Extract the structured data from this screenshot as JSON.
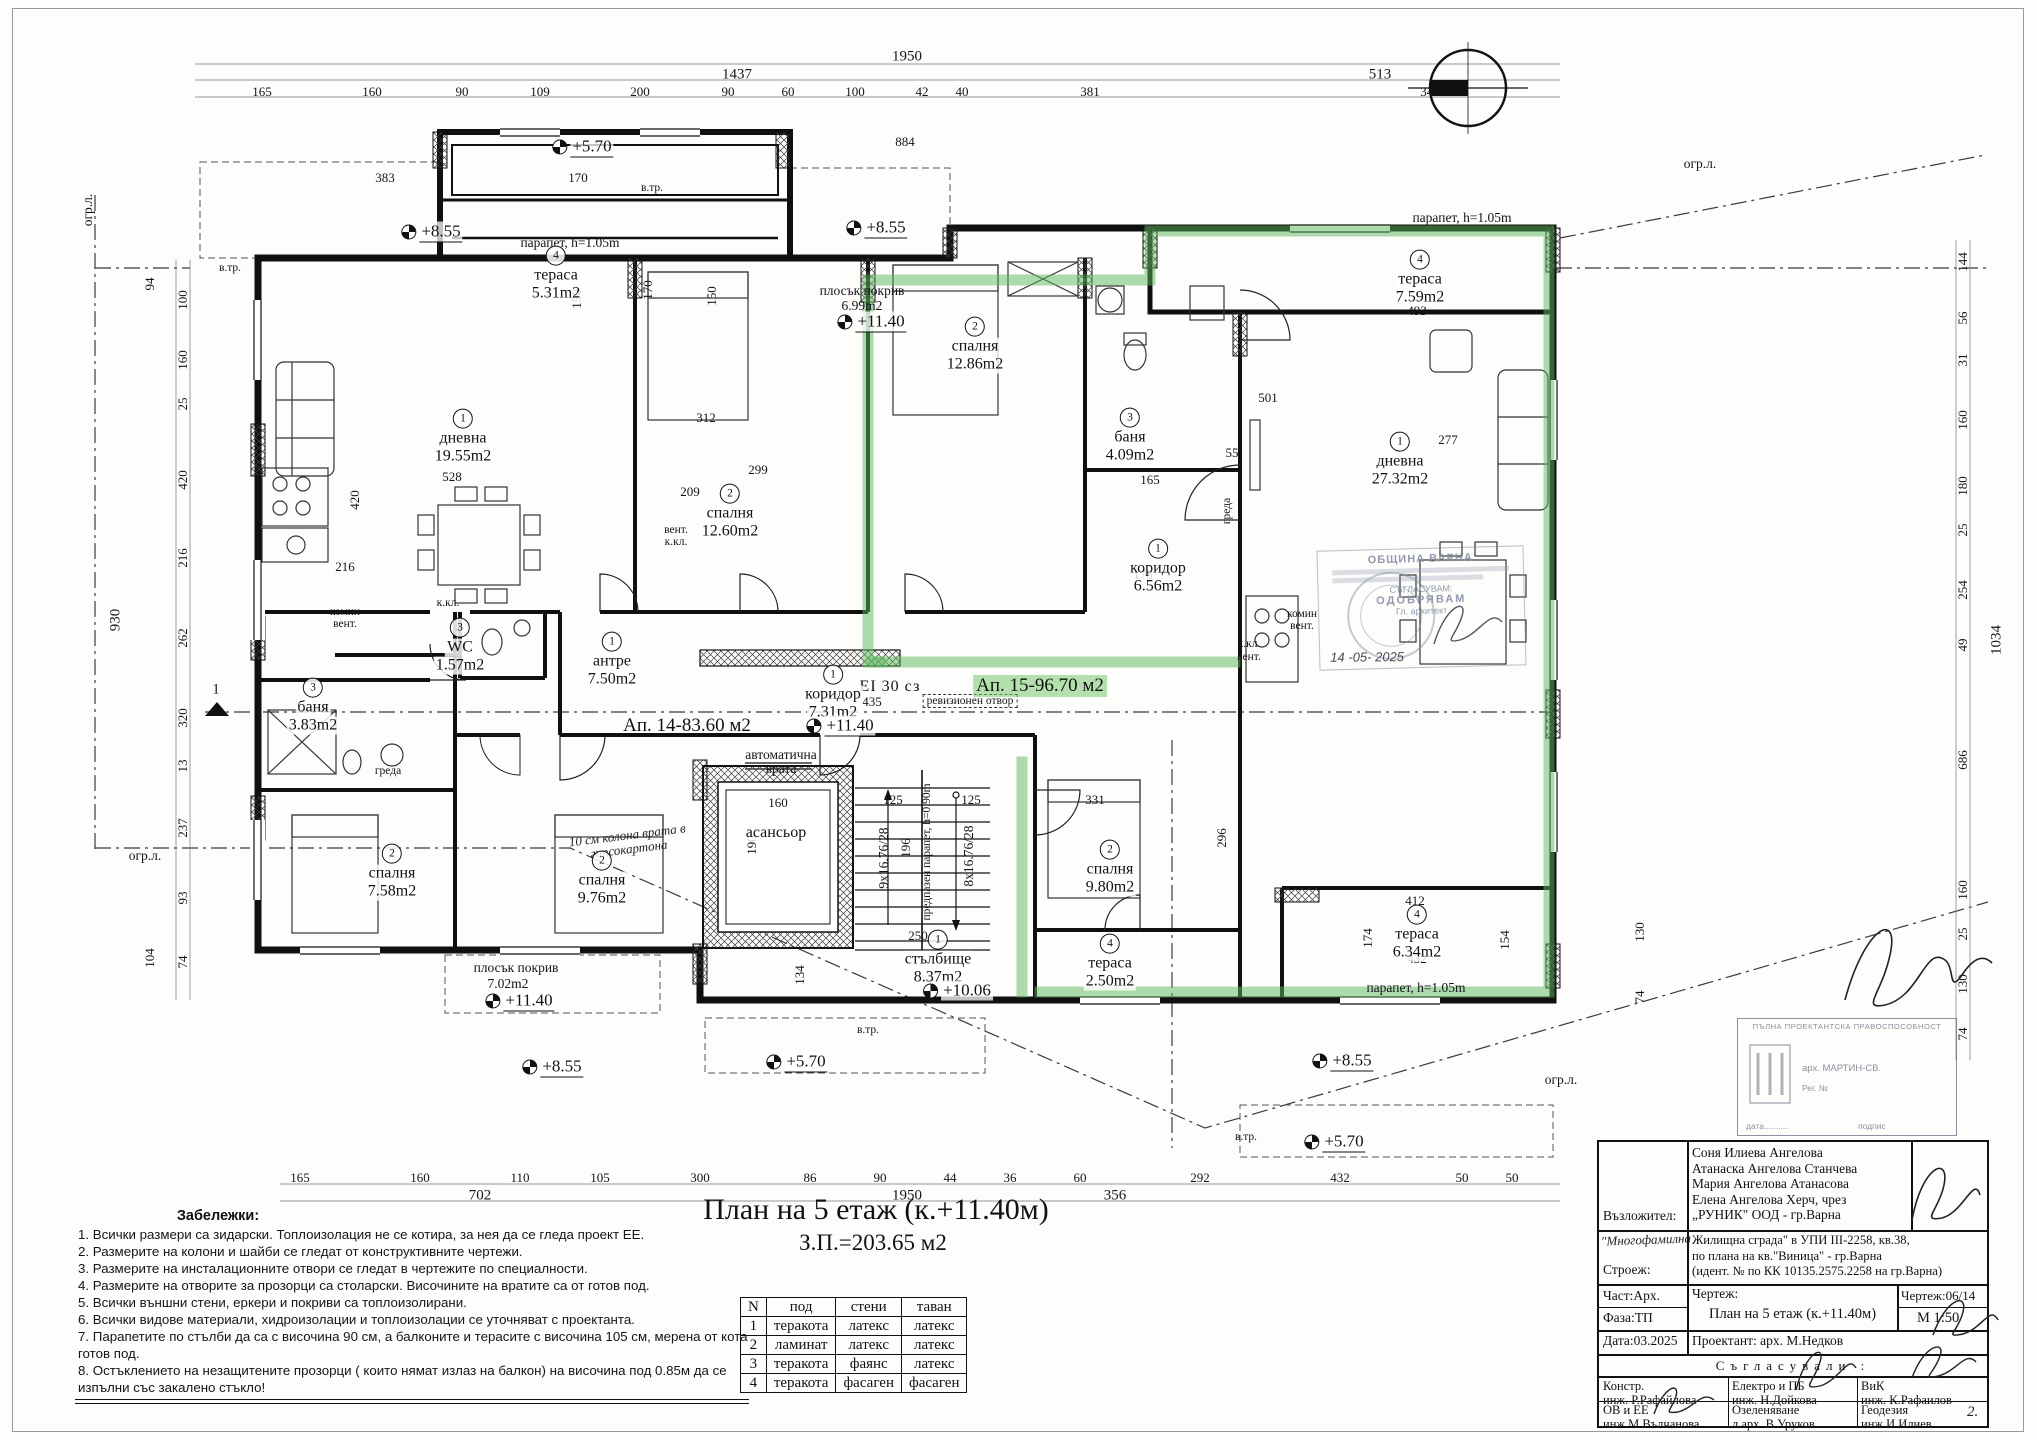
{
  "page": {
    "sheet_title": "План на 5 етаж (к.+11.40м)",
    "sheet_area": "З.П.=203.65 м2"
  },
  "colors": {
    "highlight_green": "#5cb85c",
    "ink": "#111111",
    "stamp_blue": "#8a92a8"
  },
  "apartments": [
    {
      "t": "Ап. 14-83.60 м2",
      "x": 687,
      "y": 726
    },
    {
      "t": "Ап. 15-96.70 м2",
      "x": 1040,
      "y": 686,
      "cls": "hl"
    }
  ],
  "rooms": [
    {
      "n": "4",
      "name": "тераса",
      "area": "5.31m2",
      "x": 556,
      "y": 274
    },
    {
      "n": "1",
      "name": "дневна",
      "area": "19.55m2",
      "x": 463,
      "y": 437
    },
    {
      "n": "2",
      "name": "спалня",
      "area": "12.60m2",
      "x": 730,
      "y": 512
    },
    {
      "n": "2",
      "name": "спалня",
      "area": "12.86m2",
      "x": 975,
      "y": 345
    },
    {
      "n": "3",
      "name": "баня",
      "area": "4.09m2",
      "x": 1130,
      "y": 436
    },
    {
      "n": "4",
      "name": "тераса",
      "area": "7.59m2",
      "x": 1420,
      "y": 278
    },
    {
      "n": "1",
      "name": "дневна",
      "area": "27.32m2",
      "x": 1400,
      "y": 460
    },
    {
      "n": "1",
      "name": "коридор",
      "area": "6.56m2",
      "x": 1158,
      "y": 567
    },
    {
      "n": "3",
      "name": "WC",
      "area": "1.57m2",
      "x": 460,
      "y": 646
    },
    {
      "n": "1",
      "name": "антре",
      "area": "7.50m2",
      "x": 612,
      "y": 660
    },
    {
      "n": "3",
      "name": "баня",
      "area": "3.83m2",
      "x": 313,
      "y": 706
    },
    {
      "n": "1",
      "name": "коридор",
      "area": "7.31m2",
      "x": 833,
      "y": 693
    },
    {
      "n": "2",
      "name": "спалня",
      "area": "7.58m2",
      "x": 392,
      "y": 872
    },
    {
      "n": "2",
      "name": "спалня",
      "area": "9.76m2",
      "x": 602,
      "y": 879
    },
    {
      "name": "асансьор",
      "x": 776,
      "y": 833
    },
    {
      "n": "1",
      "name": "стълбище",
      "area": "8.37m2",
      "x": 938,
      "y": 958
    },
    {
      "n": "2",
      "name": "спалня",
      "area": "9.80m2",
      "x": 1110,
      "y": 868
    },
    {
      "n": "4",
      "name": "тераса",
      "area": "2.50m2",
      "x": 1110,
      "y": 962
    },
    {
      "n": "4",
      "name": "тераса",
      "area": "6.34m2",
      "x": 1417,
      "y": 933
    }
  ],
  "elevations": [
    {
      "t": "+5.70",
      "x": 583,
      "y": 147
    },
    {
      "t": "+8.55",
      "x": 432,
      "y": 232
    },
    {
      "t": "+8.55",
      "x": 877,
      "y": 228
    },
    {
      "t": "+11.40",
      "x": 872,
      "y": 322
    },
    {
      "t": "+11.40",
      "x": 841,
      "y": 726
    },
    {
      "t": "+10.06",
      "x": 958,
      "y": 991
    },
    {
      "t": "+11.40",
      "x": 520,
      "y": 1001
    },
    {
      "t": "+5.70",
      "x": 797,
      "y": 1062
    },
    {
      "t": "+8.55",
      "x": 553,
      "y": 1067
    },
    {
      "t": "+8.55",
      "x": 1343,
      "y": 1061
    },
    {
      "t": "+5.70",
      "x": 1335,
      "y": 1142
    }
  ],
  "annotations": [
    {
      "t": "парапет, h=1.05m",
      "x": 570,
      "y": 243
    },
    {
      "t": "парапет, h=1.05m",
      "x": 1462,
      "y": 218
    },
    {
      "t": "парапет, h=1.05m",
      "x": 1416,
      "y": 988
    },
    {
      "t": "автоматична врата",
      "x": 781,
      "y": 762,
      "w": 100
    },
    {
      "t": "предпазен парапет, h=0.90m",
      "x": 927,
      "y": 852,
      "r": -90,
      "cls": "sm"
    },
    {
      "t": "9x16.76/28",
      "x": 884,
      "y": 858,
      "r": -90
    },
    {
      "t": "8x16.76/28",
      "x": 969,
      "y": 856,
      "r": -90
    },
    {
      "t": "EI 30 сз",
      "x": 890,
      "y": 687,
      "cls": "lgz"
    },
    {
      "t": "ревизионен отвор",
      "x": 970,
      "y": 701,
      "cls": "box sm"
    },
    {
      "t": "комин вент.",
      "x": 345,
      "y": 618,
      "w": 54,
      "cls": "sm"
    },
    {
      "t": "комин вент.",
      "x": 1302,
      "y": 620,
      "w": 54,
      "cls": "sm"
    },
    {
      "t": "к.кл.",
      "x": 448,
      "y": 603,
      "cls": "sm"
    },
    {
      "t": "вент.",
      "x": 676,
      "y": 530,
      "cls": "sm"
    },
    {
      "t": "к.кл.",
      "x": 676,
      "y": 542,
      "cls": "sm"
    },
    {
      "t": "к.кл.",
      "x": 1249,
      "y": 644,
      "cls": "sm"
    },
    {
      "t": "вент.",
      "x": 1249,
      "y": 657,
      "cls": "sm"
    },
    {
      "t": "греда",
      "x": 388,
      "y": 771,
      "cls": "sm"
    },
    {
      "t": "греда",
      "x": 1227,
      "y": 511,
      "r": -90,
      "cls": "sm"
    },
    {
      "t": "10 см колона врата в гипсокартона",
      "x": 628,
      "y": 842,
      "r": -7,
      "cls": "hand",
      "w": 125
    },
    {
      "t": "плосък покрив",
      "x": 862,
      "y": 291
    },
    {
      "t": "6.99m2",
      "x": 862,
      "y": 306
    },
    {
      "t": "плосък покрив",
      "x": 516,
      "y": 968
    },
    {
      "t": "7.02m2",
      "x": 508,
      "y": 984
    },
    {
      "t": "в.тр.",
      "x": 230,
      "y": 268,
      "cls": "sm"
    },
    {
      "t": "в.тр.",
      "x": 652,
      "y": 188,
      "cls": "sm"
    },
    {
      "t": "в.тр.",
      "x": 868,
      "y": 1030,
      "cls": "sm"
    },
    {
      "t": "в.тр.",
      "x": 1246,
      "y": 1137,
      "cls": "sm"
    },
    {
      "t": "огр.л.",
      "x": 88,
      "y": 210,
      "r": -90
    },
    {
      "t": "огр.л.",
      "x": 1700,
      "y": 164
    },
    {
      "t": "огр.л.",
      "x": 1561,
      "y": 1080
    },
    {
      "t": "огр.л.",
      "x": 145,
      "y": 856
    }
  ],
  "dims": [
    {
      "t": "1950",
      "x": 907,
      "y": 57,
      "cls": "lg"
    },
    {
      "t": "1437",
      "x": 737,
      "y": 75,
      "cls": "lg"
    },
    {
      "t": "513",
      "x": 1380,
      "y": 75,
      "cls": "lg"
    },
    {
      "t": "165",
      "x": 262,
      "y": 92
    },
    {
      "t": "160",
      "x": 372,
      "y": 92
    },
    {
      "t": "90",
      "x": 462,
      "y": 92
    },
    {
      "t": "109",
      "x": 540,
      "y": 92
    },
    {
      "t": "200",
      "x": 640,
      "y": 92
    },
    {
      "t": "90",
      "x": 728,
      "y": 92
    },
    {
      "t": "60",
      "x": 788,
      "y": 92
    },
    {
      "t": "100",
      "x": 855,
      "y": 92
    },
    {
      "t": "42",
      "x": 922,
      "y": 92
    },
    {
      "t": "40",
      "x": 962,
      "y": 92
    },
    {
      "t": "381",
      "x": 1090,
      "y": 92
    },
    {
      "t": "343",
      "x": 1430,
      "y": 92
    },
    {
      "t": "884",
      "x": 905,
      "y": 142
    },
    {
      "t": "170",
      "x": 578,
      "y": 178
    },
    {
      "t": "383",
      "x": 385,
      "y": 178
    },
    {
      "t": "493",
      "x": 1417,
      "y": 311
    },
    {
      "t": "165",
      "x": 300,
      "y": 1178
    },
    {
      "t": "160",
      "x": 420,
      "y": 1178
    },
    {
      "t": "110",
      "x": 520,
      "y": 1178
    },
    {
      "t": "105",
      "x": 600,
      "y": 1178
    },
    {
      "t": "300",
      "x": 700,
      "y": 1178
    },
    {
      "t": "86",
      "x": 810,
      "y": 1178
    },
    {
      "t": "90",
      "x": 880,
      "y": 1178
    },
    {
      "t": "44",
      "x": 950,
      "y": 1178
    },
    {
      "t": "36",
      "x": 1010,
      "y": 1178
    },
    {
      "t": "60",
      "x": 1080,
      "y": 1178
    },
    {
      "t": "292",
      "x": 1200,
      "y": 1178
    },
    {
      "t": "432",
      "x": 1340,
      "y": 1178
    },
    {
      "t": "50",
      "x": 1462,
      "y": 1178
    },
    {
      "t": "50",
      "x": 1512,
      "y": 1178
    },
    {
      "t": "702",
      "x": 480,
      "y": 1196,
      "cls": "lg"
    },
    {
      "t": "1950",
      "x": 907,
      "y": 1196,
      "cls": "lg"
    },
    {
      "t": "356",
      "x": 1115,
      "y": 1196,
      "cls": "lg"
    },
    {
      "t": "100",
      "x": 183,
      "y": 300,
      "r": -90
    },
    {
      "t": "160",
      "x": 183,
      "y": 360,
      "r": -90
    },
    {
      "t": "25",
      "x": 183,
      "y": 404,
      "r": -90
    },
    {
      "t": "420",
      "x": 183,
      "y": 480,
      "r": -90
    },
    {
      "t": "216",
      "x": 183,
      "y": 558,
      "r": -90
    },
    {
      "t": "262",
      "x": 183,
      "y": 638,
      "r": -90
    },
    {
      "t": "320",
      "x": 183,
      "y": 718,
      "r": -90
    },
    {
      "t": "13",
      "x": 183,
      "y": 766,
      "r": -90
    },
    {
      "t": "237",
      "x": 183,
      "y": 828,
      "r": -90
    },
    {
      "t": "93",
      "x": 183,
      "y": 898,
      "r": -90
    },
    {
      "t": "74",
      "x": 183,
      "y": 962,
      "r": -90
    },
    {
      "t": "94",
      "x": 150,
      "y": 284,
      "r": -90
    },
    {
      "t": "930",
      "x": 116,
      "y": 620,
      "r": -90,
      "cls": "lg"
    },
    {
      "t": "104",
      "x": 150,
      "y": 958,
      "r": -90
    },
    {
      "t": "144",
      "x": 1963,
      "y": 262,
      "r": -90
    },
    {
      "t": "56",
      "x": 1963,
      "y": 318,
      "r": -90
    },
    {
      "t": "31",
      "x": 1963,
      "y": 360,
      "r": -90
    },
    {
      "t": "160",
      "x": 1963,
      "y": 420,
      "r": -90
    },
    {
      "t": "180",
      "x": 1963,
      "y": 486,
      "r": -90
    },
    {
      "t": "25",
      "x": 1963,
      "y": 530,
      "r": -90
    },
    {
      "t": "254",
      "x": 1963,
      "y": 590,
      "r": -90
    },
    {
      "t": "49",
      "x": 1963,
      "y": 645,
      "r": -90
    },
    {
      "t": "686",
      "x": 1963,
      "y": 760,
      "r": -90
    },
    {
      "t": "160",
      "x": 1963,
      "y": 890,
      "r": -90
    },
    {
      "t": "25",
      "x": 1963,
      "y": 934,
      "r": -90
    },
    {
      "t": "130",
      "x": 1963,
      "y": 984,
      "r": -90
    },
    {
      "t": "74",
      "x": 1963,
      "y": 1034,
      "r": -90
    },
    {
      "t": "1034",
      "x": 1997,
      "y": 640,
      "r": -90,
      "cls": "lg"
    },
    {
      "t": "130",
      "x": 1640,
      "y": 932,
      "r": -90
    },
    {
      "t": "74",
      "x": 1640,
      "y": 997,
      "r": -90
    },
    {
      "t": "412",
      "x": 1415,
      "y": 901
    },
    {
      "t": "432",
      "x": 1417,
      "y": 959
    },
    {
      "t": "174",
      "x": 1368,
      "y": 938,
      "r": -90
    },
    {
      "t": "154",
      "x": 1505,
      "y": 940,
      "r": -90
    },
    {
      "t": "528",
      "x": 452,
      "y": 477
    },
    {
      "t": "420",
      "x": 355,
      "y": 500,
      "r": -90
    },
    {
      "t": "216",
      "x": 345,
      "y": 567
    },
    {
      "t": "209",
      "x": 690,
      "y": 492
    },
    {
      "t": "299",
      "x": 758,
      "y": 470
    },
    {
      "t": "312",
      "x": 706,
      "y": 418
    },
    {
      "t": "178",
      "x": 1143,
      "y": 575
    },
    {
      "t": "165",
      "x": 1150,
      "y": 480
    },
    {
      "t": "55",
      "x": 1232,
      "y": 453
    },
    {
      "t": "331",
      "x": 1095,
      "y": 800
    },
    {
      "t": "296",
      "x": 1222,
      "y": 838,
      "r": -90
    },
    {
      "t": "160",
      "x": 778,
      "y": 803
    },
    {
      "t": "190",
      "x": 752,
      "y": 845,
      "r": -90
    },
    {
      "t": "125",
      "x": 893,
      "y": 800
    },
    {
      "t": "125",
      "x": 971,
      "y": 800
    },
    {
      "t": "196",
      "x": 906,
      "y": 848,
      "r": -90
    },
    {
      "t": "134",
      "x": 800,
      "y": 975,
      "r": -90
    },
    {
      "t": "250",
      "x": 918,
      "y": 936
    },
    {
      "t": "435",
      "x": 872,
      "y": 702
    },
    {
      "t": "277",
      "x": 1448,
      "y": 440
    },
    {
      "t": "501",
      "x": 1268,
      "y": 398
    },
    {
      "t": "150",
      "x": 577,
      "y": 299,
      "r": -90
    },
    {
      "t": "170",
      "x": 648,
      "y": 290,
      "r": -90
    },
    {
      "t": "150",
      "x": 712,
      "y": 296,
      "r": -90
    },
    {
      "t": "1",
      "x": 216,
      "y": 690,
      "cls": "lg"
    }
  ],
  "notes": {
    "heading": "Забележки:",
    "items": [
      "1. Всички размери са зидарски. Топлоизолация не се котира, за нея да се гледа проект ЕЕ.",
      "2. Размерите на колони и шайби се гледат от конструктивните чертежи.",
      "3. Размерите на инсталационните отвори се гледат в чертежите по специалности.",
      "4. Размерите на отворите за прозорци са столарски. Височините на вратите са от готов под.",
      "5. Всички външни стени, еркери и покриви са топлоизолирани.",
      "6. Всички видове материали, хидроизолации и топлоизолации се уточняват с проектанта.",
      "7. Парапетите по стълби да са с височина 90 см, а балконите и терасите  с височина 105 см, мерена от кота готов под.",
      "8. Остъклението на незащитените прозорци  ( които нямат излаз на балкон)  на височина под 0.85м да се изпълни със закалено стъкло!"
    ]
  },
  "finish_table": {
    "headers": [
      "N",
      "под",
      "стени",
      "таван"
    ],
    "rows": [
      [
        "1",
        "теракота",
        "латекс",
        "латекс"
      ],
      [
        "2",
        "ламинат",
        "латекс",
        "латекс"
      ],
      [
        "3",
        "теракота",
        "фаянс",
        "латекс"
      ],
      [
        "4",
        "теракота",
        "фасаген",
        "фасаген"
      ]
    ]
  },
  "title_block": {
    "client_label": "Възложител:",
    "client_names": [
      "Соня Илиева Ангелова",
      "Атанаска Ангелова Станчева",
      "Мария Ангелова Атанасова",
      "Елена Ангелова Херч, чрез",
      "„РУНИК\" ООД - гр.Варна"
    ],
    "project_label": "Строеж:",
    "project_pre": "\"Многофамилна",
    "project_lines": [
      "Жилищна сграда\" в УПИ III-2258, кв.38,",
      "по плана на кв.\"Виница\" - гр.Варна",
      "(идент. № по КК 10135.2575.2258 на гр.Варна)"
    ],
    "part_label": "Част:Арх.",
    "phase_label": "Фаза:ТП",
    "date_label": "Дата:03.2025",
    "drawing_label": "Чертеж:",
    "drawing_title": "План на 5 етаж (к.+11.40м)",
    "sheet_no": "Чертеж:06/14",
    "scale": "М 1:50",
    "designer": "Проектант: арх. М.Недков",
    "agreed_heading": "Съгласували :",
    "signers": [
      {
        "role": "Констр.",
        "name": "инж. Р.Рафайлова"
      },
      {
        "role": "Електро и ПБ",
        "name": "инж. Н.Дойкова"
      },
      {
        "role": "ВиК",
        "name": "инж. К.Рафаилов"
      },
      {
        "role": "ОВ и ЕЕ",
        "name": "инж.М.Вълчанова"
      },
      {
        "role": "Озеленяване",
        "name": "л.арх. В.Уруков"
      },
      {
        "role": "Геодезия",
        "name": "инж.И.Илиев"
      }
    ],
    "handwritten_no": "2."
  },
  "stamps": {
    "municipality": {
      "line1": "ОБЩИНА ВАРНА",
      "line2": "СЪГЛАСУВАМ:",
      "line3": "ОДОБРЯВАМ",
      "line4": "Гл. архитект",
      "date": "14 -05- 2025"
    },
    "license": {
      "title": "ПЪЛНА ПРОЕКТАНТСКА ПРАВОСПОСОБНОСТ",
      "name": "арх. МАРТИН-СВ.",
      "reg": "Рег. №",
      "date_label": "дата..........",
      "sign_label": "подпис"
    }
  }
}
